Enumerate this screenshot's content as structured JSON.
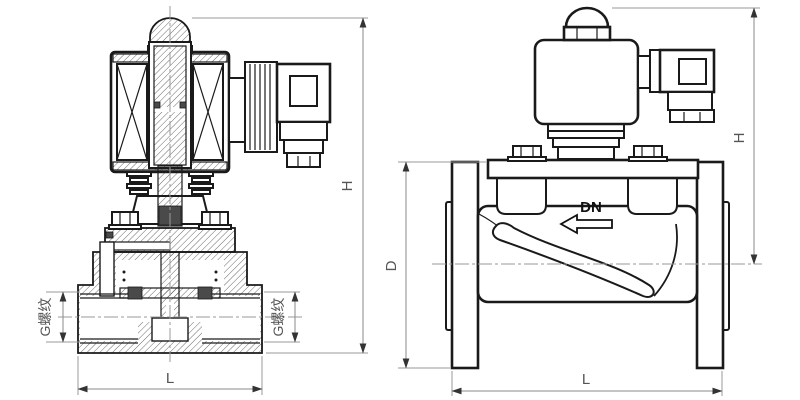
{
  "drawing": {
    "kind": "engineering-drawing",
    "subject": "solenoid valve, sectional view (threaded) and external view (flanged)",
    "colors": {
      "line": "#1a1a1a",
      "dimension_line": "#8a8a8a",
      "label_text": "#555555",
      "background": "#ffffff"
    },
    "left_view": {
      "name": "threaded-solenoid-valve-section",
      "labels": {
        "height": "H",
        "length": "L",
        "thread_left": "G螺纹",
        "thread_right": "G螺纹"
      }
    },
    "right_view": {
      "name": "flanged-solenoid-valve-external",
      "labels": {
        "height": "H",
        "length": "L",
        "flange_diameter": "D",
        "nominal_bore": "DN"
      },
      "flow_direction_icon": "arrow-left"
    }
  }
}
